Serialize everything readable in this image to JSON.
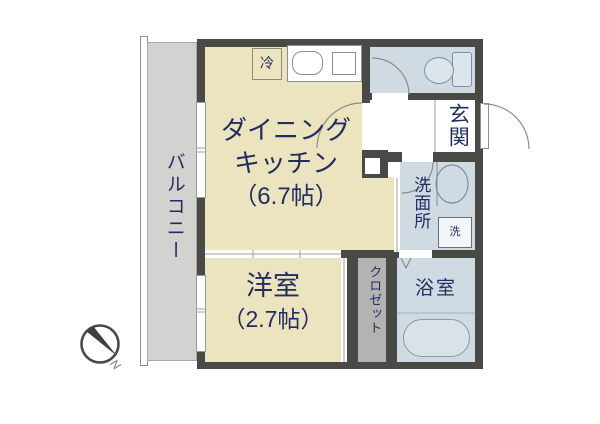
{
  "plan": {
    "rooms": {
      "balcony": {
        "label": "バルコニー"
      },
      "dining_kitchen": {
        "label_line1": "ダイニング",
        "label_line2": "キッチン",
        "size_label": "（6.7帖）"
      },
      "western_room": {
        "label": "洋室",
        "size_label": "（2.7帖）"
      },
      "closet": {
        "label": "クロゼット"
      },
      "entrance": {
        "label": "玄関"
      },
      "washroom": {
        "label": "洗面所"
      },
      "bathroom": {
        "label": "浴室"
      }
    },
    "fixtures": {
      "refrigerator": {
        "label": "冷"
      },
      "washing_machine": {
        "label": "洗"
      }
    },
    "compass": {
      "north_label": "N"
    },
    "colors": {
      "wall": "#494946",
      "room_cream": "#ece3bf",
      "room_blue": "#cfdae3",
      "balcony_gray": "#d2d2d0",
      "closet_gray": "#b3b3b1",
      "label_navy": "#222d63",
      "line_gray": "#8c8c8a"
    }
  }
}
